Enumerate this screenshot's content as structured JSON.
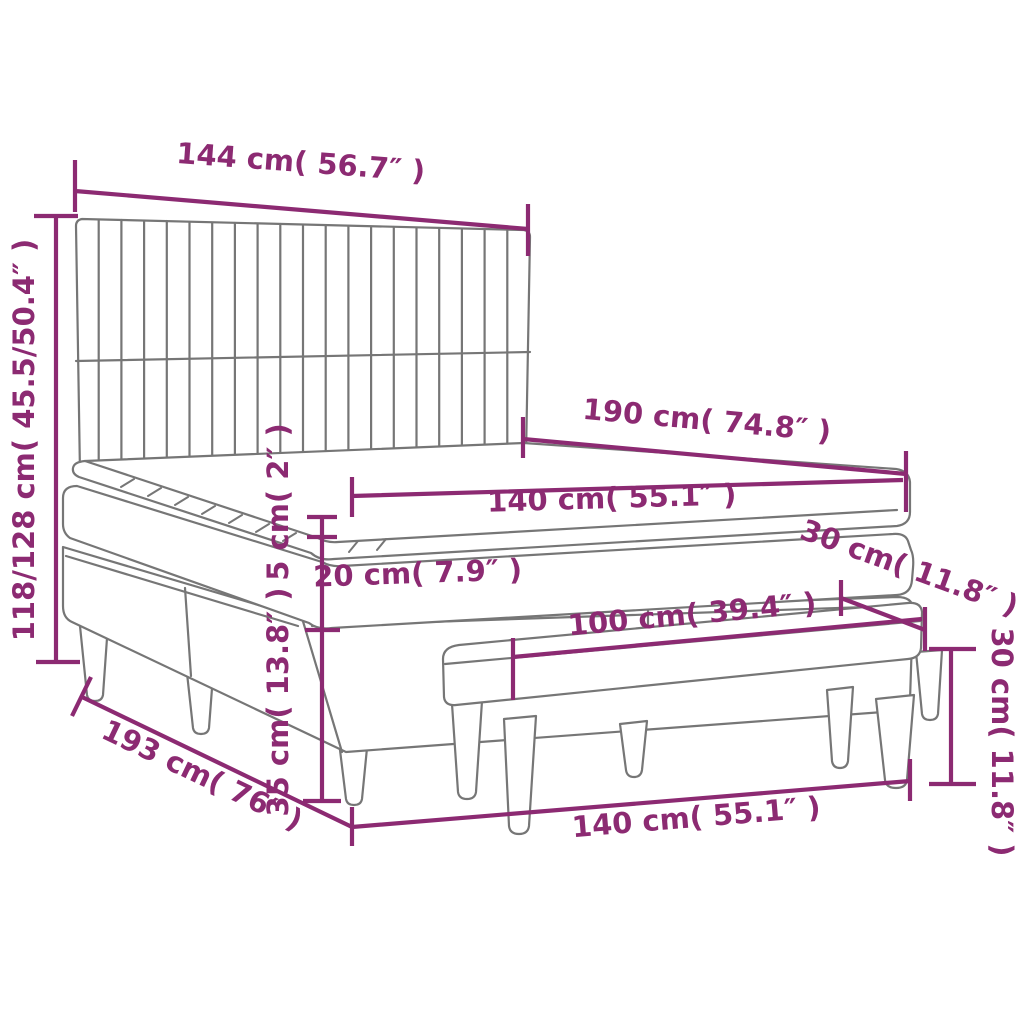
{
  "colors": {
    "dimension_text": "#8C2A72",
    "drawing_outline": "#767676",
    "background": "#FFFFFF"
  },
  "diagram": {
    "labels": {
      "headboard_width": "144 cm( 56.7″ )",
      "headboard_height_range": "118/128 cm( 45.5/50.4″ )",
      "bed_length": "190 cm( 74.8″ )",
      "mattress_width": "140 cm( 55.1″ )",
      "topper_height": "5 cm( 2″ )",
      "mattress_height": "20 cm( 7.9″ )",
      "base_height": "35 cm( 13.8″ )",
      "total_length": "193 cm( 76″ )",
      "bench_length": "100 cm( 39.4″ )",
      "bench_depth": "30 cm( 11.8″ )",
      "bench_height": "30 cm( 11.8″ )",
      "bottom_width": "140 cm( 55.1″ )"
    }
  }
}
